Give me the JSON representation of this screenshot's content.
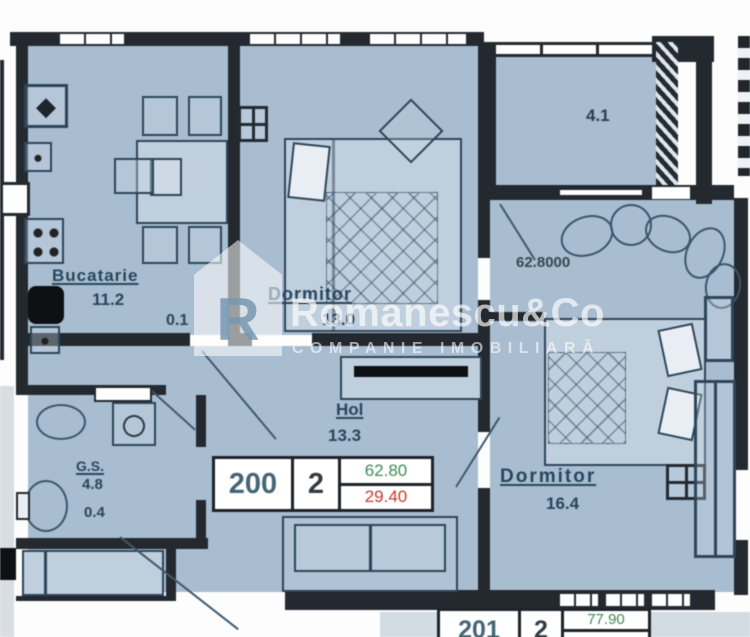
{
  "plan": {
    "kitchen": {
      "label": "Bucatarie",
      "area": "11.2",
      "area2": "0.1"
    },
    "bedroom1": {
      "label": "Dormitor",
      "area": "13.0"
    },
    "balcony": {
      "area": "4.1"
    },
    "living": {
      "dimension": "62.8000"
    },
    "hall": {
      "label": "Hol",
      "area": "13.3"
    },
    "bathroom": {
      "label": "G.S.",
      "area": "4.8",
      "area2": "0.4"
    },
    "bedroom2": {
      "label": "Dormitor",
      "area": "16.4"
    }
  },
  "tags": {
    "current": {
      "number": "200",
      "rooms": "2",
      "total_area": "62.80",
      "living_area": "29.40"
    },
    "next": {
      "number": "201",
      "rooms": "2",
      "total_area": "77.90"
    }
  },
  "watermark": {
    "brand": "Romanescu&Co",
    "tagline": "COMPANIE IMOBILIARĂ",
    "monogram": "R"
  },
  "icons": {
    "ventilation": "◆"
  },
  "colors": {
    "room_fill": "#a9bdd1",
    "wall": "#23292f",
    "label_ink": "#27465c",
    "area_green": "#3e8a55",
    "area_red": "#c8392b",
    "tag_number": "#456575"
  }
}
